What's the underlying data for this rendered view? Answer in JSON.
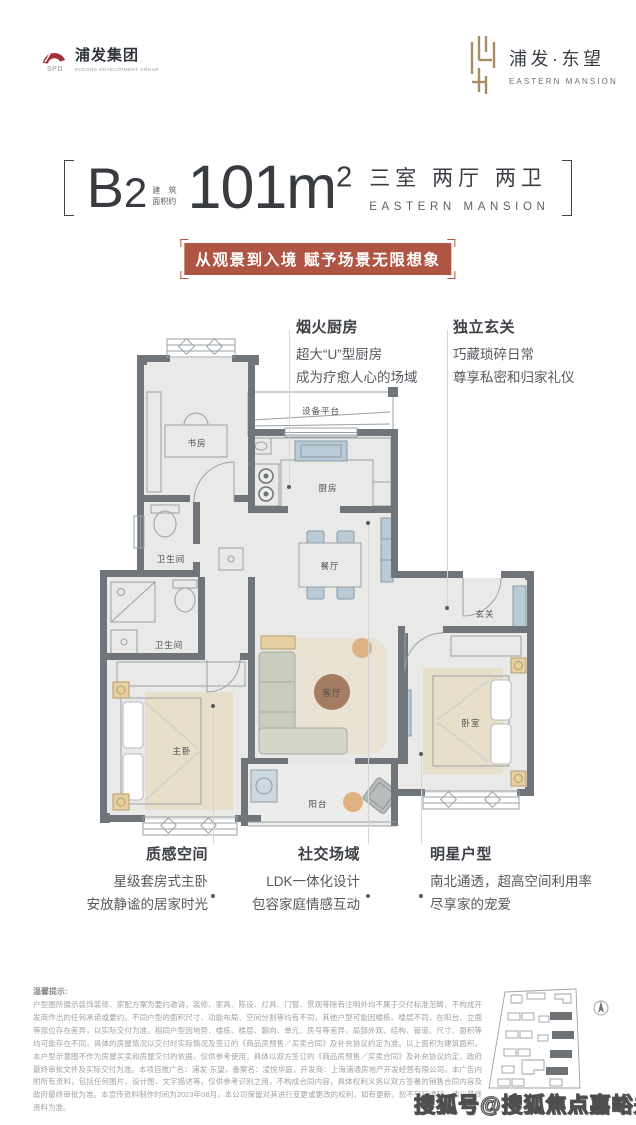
{
  "header": {
    "left_logo": {
      "title": "浦发集团",
      "subtitle": "PUDONG DEVELOPMENT GROUP"
    },
    "right_logo": {
      "title": "浦发·东望",
      "subtitle": "EASTERN MANSION"
    }
  },
  "title": {
    "unit_letter": "B",
    "unit_digit": "2",
    "area_label_1": "建 筑",
    "area_label_2": "面积约",
    "area_number": "101m",
    "area_exponent": "2",
    "rooms_cn": "三室 两厅 两卫",
    "rooms_en": "EASTERN MANSION"
  },
  "banner": {
    "text": "从观景到入境 赋予场景无限想象",
    "bg_color": "#b05443"
  },
  "callouts": {
    "kitchen": {
      "title": "烟火厨房",
      "line1": "超大“U”型厨房",
      "line2": "成为疗愈人心的场域"
    },
    "entry": {
      "title": "独立玄关",
      "line1": "巧藏琐碎日常",
      "line2": "尊享私密和归家礼仪"
    },
    "master": {
      "title": "质感空间",
      "line1": "星级套房式主卧",
      "line2": "安放静谧的居家时光"
    },
    "social": {
      "title": "社交场域",
      "line1": "LDK一体化设计",
      "line2": "包容家庭情感互动"
    },
    "star": {
      "title": "明星户型",
      "line1": "南北通透，超高空间利用率",
      "line2": "尽享家的宠爱"
    }
  },
  "floorplan": {
    "rooms": {
      "study": "书房",
      "bath_upper": "卫生间",
      "bath_lower": "卫生间",
      "master_bedroom": "主卧",
      "kitchen": "厨房",
      "dining": "餐厅",
      "living": "客厅",
      "balcony": "阳台",
      "entry": "玄关",
      "bedroom": "卧室",
      "equipment_platform": "设备平台"
    },
    "colors": {
      "wall": "#70757b",
      "floor": "#e9e9e7",
      "furniture_blue": "#b9cbd7",
      "rug_tan": "#e7dfc9",
      "table_wood": "#a37c61",
      "accent_red": "#b05443",
      "logo_gold": "#a68d68"
    }
  },
  "disclaimer": {
    "title": "温馨提示:",
    "body": "户型图所展示装饰装修、家配方案为要约邀请，装修、家具、陈设、灯具、门窗、景观等除有注明外均不属于交付标准范畴，不构成开发商作出的任何承诺或要约。不同户型的面积尺寸、功能布局、空间分割等均有不同，其他户型可能因楼栋、楼层不同，在阳台、立面等部位存在差异，以实际交付为准。相同户型因地势、楼栋、楼层、朝向、单元、房号等差异，局部外观、结构、管道、尺寸、面积等均可能存在不同，具体的房屋情况以交付时实际情况及签订的《商品房预售／买卖合同》及补充协议约定为准。以上面积为建筑面积，本户型示意图不作为房屋买卖和房屋交付的依据，仅供参考使用，具体以双方签订的《商品房预售／买卖合同》及补充协议约定、政府最终审批文件及实际交付为准。本项目推广名：浦发·东望，备案名：凌悦华庭，开发商：上海浦通房地产开发经营有限公司。本广告内附所有资料，包括任何图片、设计图、文字描述等，仅供参考识别之用，不构成合同内容，具体权利义务以双方签署的销售合同内容及政府最终审批为准。本宣传资料制作时间为2023年08月，本公司保留对其进行变更或更改的权利，如有更新，恕不另行通知，请以最终资料为准。"
  },
  "watermark": "搜狐号@搜狐焦点嘉峪关站"
}
